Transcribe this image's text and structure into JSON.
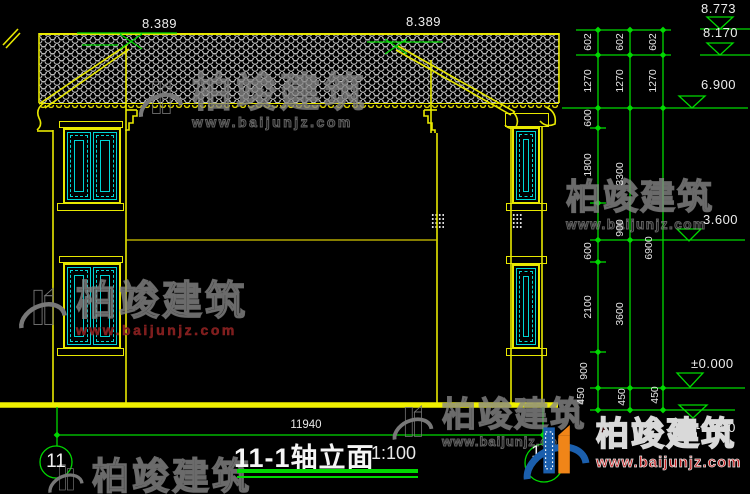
{
  "title_block": {
    "title": "11-1轴立面",
    "scale": "1:100"
  },
  "axis_bubbles": {
    "left": "11",
    "right": "1"
  },
  "dims": {
    "overall_width": "11940",
    "ridge_left": "8.389",
    "ridge_right": "8.389",
    "elevations": [
      "8.773",
      "8.170",
      "6.900",
      "3.600",
      "±0.000",
      "-0.450"
    ],
    "chain_inner": [
      "602",
      "1270",
      "600",
      "1800",
      "900",
      "600",
      "2100",
      "900",
      "450"
    ],
    "chain_middle": [
      "602",
      "1270",
      "3300",
      "3600",
      "450"
    ],
    "chain_outer": [
      "602",
      "1270",
      "6900",
      "450"
    ]
  },
  "watermark": {
    "brand": "柏竣建筑",
    "url": "www.baijunjz.com"
  },
  "colors": {
    "line_yellow": "#e8e800",
    "dim_green": "#00d900",
    "window_cyan": "#00d5d5",
    "brand_red": "#c22222",
    "logo_blue": "#1b5fad",
    "logo_orange": "#f08518"
  }
}
